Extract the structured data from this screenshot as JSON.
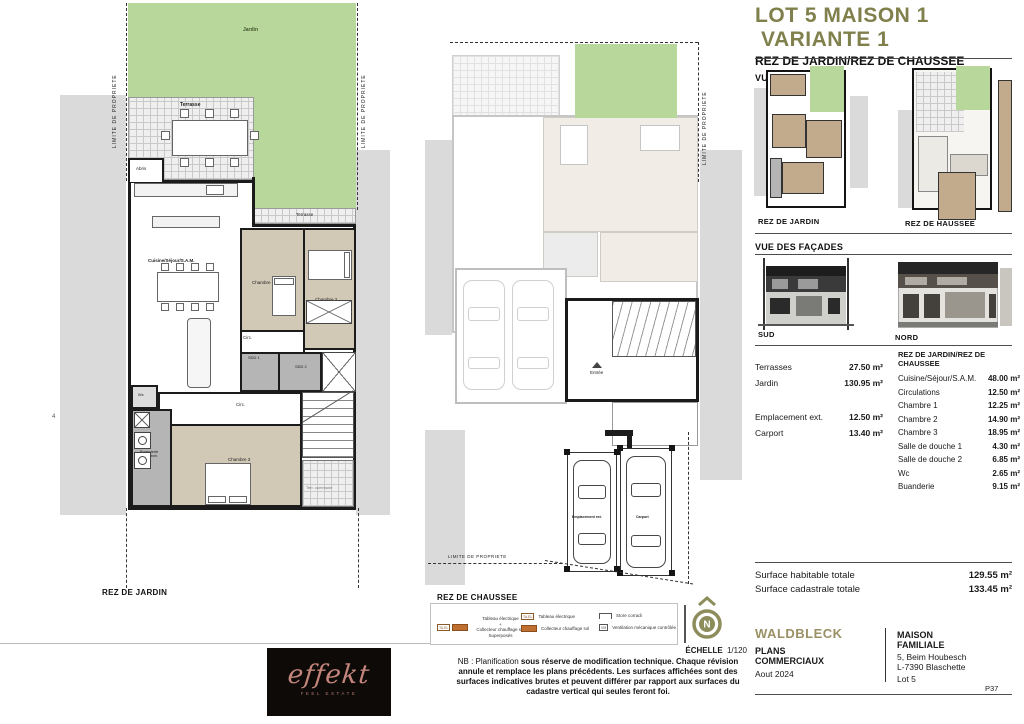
{
  "common": {
    "limite": "LIMITE DE PROPRIETE"
  },
  "left_plan": {
    "title": "REZ DE JARDIN",
    "labels": {
      "jardin": "Jardin",
      "terrasse": "Terrasse",
      "abris": "Abris",
      "cuisine": "Cuisine/Séjour/S.A.M.",
      "chambre1": "Chambre 1",
      "chambre2": "Chambre 2",
      "chambre3": "Chambre 3",
      "circ": "Circ.",
      "sdd1": "SDD 1",
      "sdd2": "SDD 2",
      "wc": "Wc",
      "buanderie_l1": "Buanderie",
      "buanderie_l2": "local tech.",
      "terr_commune": "Terr. commune",
      "dim": "4"
    }
  },
  "center_plan": {
    "title": "REZ DE CHAUSSEE",
    "entree": "Entrée",
    "emplacement": "Emplacement ext.",
    "carport": "Carport"
  },
  "header": {
    "title1": "LOT 5 MAISON 1",
    "title2": "VARIANTE 1",
    "subtitle": "REZ DE JARDIN/REZ DE CHAUSSEE",
    "vue_plan": "VUE EN PLAN",
    "vue_facades": "VUE DES FAÇADES"
  },
  "thumbs": {
    "left": "REZ DE JARDIN",
    "right": "REZ DE HAUSSEE"
  },
  "facades": {
    "sud": "SUD",
    "nord": "NORD"
  },
  "areas": {
    "left": [
      {
        "label": "Terrasses",
        "value": "27.50 m²"
      },
      {
        "label": "Jardin",
        "value": "130.95 m²"
      },
      {
        "label": "Emplacement ext.",
        "value": "12.50 m²"
      },
      {
        "label": "Carport",
        "value": "13.40 m²"
      }
    ],
    "right_header": "REZ DE JARDIN/REZ DE CHAUSSEE",
    "right": [
      {
        "label": "Cuisine/Séjour/S.A.M.",
        "value": "48.00 m²"
      },
      {
        "label": "Circulations",
        "value": "12.50 m²"
      },
      {
        "label": "Chambre 1",
        "value": "12.25 m²"
      },
      {
        "label": "Chambre 2",
        "value": "14.90 m²"
      },
      {
        "label": "Chambre 3",
        "value": "18.95 m²"
      },
      {
        "label": "Salle de douche 1",
        "value": "4.30 m²"
      },
      {
        "label": "Salle de douche 2",
        "value": "6.85 m²"
      },
      {
        "label": "Wc",
        "value": "2.65 m²"
      },
      {
        "label": "Buanderie",
        "value": "9.15 m²"
      }
    ]
  },
  "totals": [
    {
      "label": "Surface habitable totale",
      "value": "129.55 m²"
    },
    {
      "label": "Surface cadastrale totale",
      "value": "133.45 m²"
    }
  ],
  "legend": {
    "sym_ta": "TA.EL",
    "sym_vm": "VM",
    "tableau": "Tableau électrique",
    "plus": "+",
    "collecteur": "Collecteur chauffage sol",
    "superposes": "Superposés",
    "store": "Store corradi",
    "vmc": "Ventilation mécanique contrôlée"
  },
  "notes": {
    "echelle_label": "ÉCHELLE",
    "echelle_value": "1/120",
    "nb_normal": "NB : Planification ",
    "nb_bold": "sous réserve de modification technique. Chaque révision annule et remplace les plans précédents. Les surfaces affichées sont des surfaces indicatives brutes et peuvent différer par rapport aux surfaces du cadastre vertical qui seules feront foi."
  },
  "compass": {
    "n": "N"
  },
  "logo": {
    "name": "effekt",
    "tagline": "feel estate"
  },
  "footer": {
    "brand": "WALDBLECK",
    "doc1": "PLANS",
    "doc2": "COMMERCIAUX",
    "date": "Aout 2024",
    "proj1": "MAISON",
    "proj2": "FAMILIALE",
    "addr1": "5, Beim Houbesch",
    "addr2": "L-7390 Blaschette",
    "lot": "Lot 5",
    "page": "P37"
  }
}
